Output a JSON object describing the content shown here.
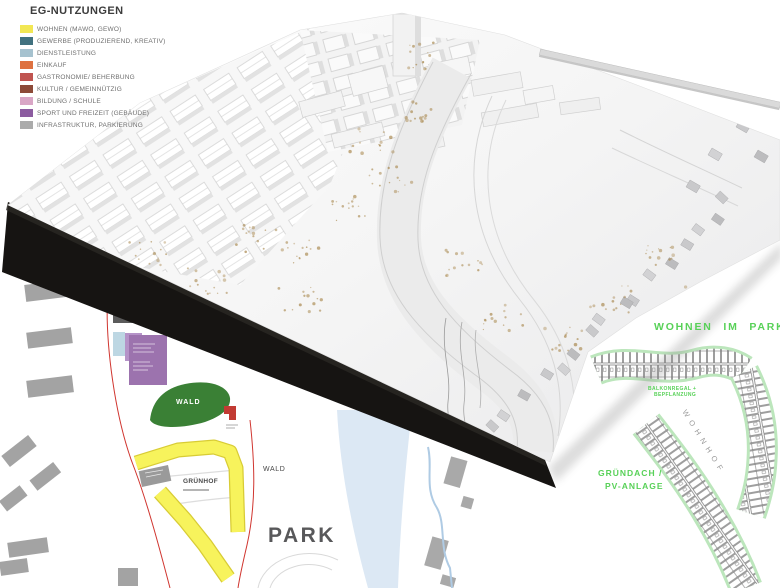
{
  "legend": {
    "title": "EG-NUTZUNGEN",
    "items": [
      {
        "label": "WOHNEN (MAWO, GEWO)",
        "color": "#F2E754"
      },
      {
        "label": "GEWERBE (PRODUZIEREND, KREATIV)",
        "color": "#41717F"
      },
      {
        "label": "DIENSTLEISTUNG",
        "color": "#A6C2CF"
      },
      {
        "label": "EINKAUF",
        "color": "#DE7140"
      },
      {
        "label": "GASTRONOMIE/ BEHERBUNG",
        "color": "#C05450"
      },
      {
        "label": "KULTUR / GEMEINNÜTZIG",
        "color": "#8C4A38"
      },
      {
        "label": "BILDUNG / SCHULE",
        "color": "#D9A6C6"
      },
      {
        "label": "SPORT UND FREIZEIT (GEBÄUDE)",
        "color": "#8C5CA0"
      },
      {
        "label": "INFRASTRUKTUR, PARKIERUNG",
        "color": "#ABABAB"
      }
    ]
  },
  "site_plan": {
    "park_label": "PARK",
    "wald_area_label": "WALD",
    "wald_small_label": "WALD",
    "gruenhof_label": "GRÜNHOF",
    "colors": {
      "wald_green": "#3A8035",
      "gruenhof_yellow": "#F7F35C",
      "gruenhof_outline": "#D8CC35",
      "river_blue": "#DCE8F4",
      "creek_blue": "#AFCBE4",
      "building_gray": "#A3A3A3",
      "boundary_red": "#D0352F",
      "culture_purple": "#9C73AE",
      "culture_purple_light": "#B593C8",
      "gastro_brown": "#8A594B",
      "accent_red": "#C23B33",
      "park_text": "#58585A"
    }
  },
  "annotations": {
    "text_green": "#58D158",
    "wohnen_im_park": "WOHNEN IM PARK",
    "balkon_line1": "BALKONREGAL +",
    "balkon_line2": "BEPFLANZUNG",
    "wohnhof": "WOHNHOF",
    "gruendach_line1": "GRÜNDACH /",
    "gruendach_line2": "PV-ANLAGE"
  }
}
